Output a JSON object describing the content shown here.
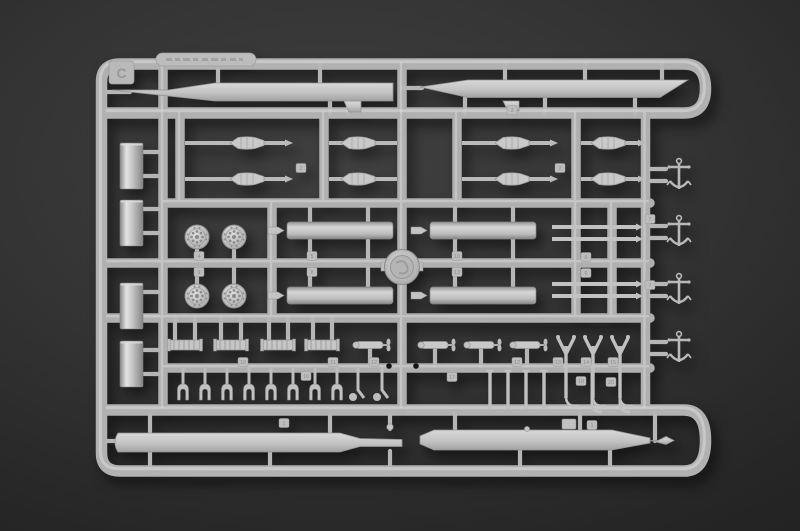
{
  "scene": {
    "subject": "Plastic model kit sprue C with molded ship parts photographed on a dark gray surface",
    "background_color": "#2e2e2e",
    "sprue_color": "#b3b3b3",
    "part_color": "#c8c8c8",
    "hole_color": "#141414"
  },
  "sprue": {
    "letter": "C",
    "nameplate": {
      "description": "embossed oval tag with illegible raised lettering",
      "legible": false
    },
    "part_number_tags": [
      {
        "label": "2",
        "x": 301,
        "y": 168
      },
      {
        "label": "2",
        "x": 560,
        "y": 168
      },
      {
        "label": "4",
        "x": 199,
        "y": 256
      },
      {
        "label": "9",
        "x": 199,
        "y": 272
      },
      {
        "label": "5",
        "x": 312,
        "y": 256
      },
      {
        "label": "8",
        "x": 312,
        "y": 272
      },
      {
        "label": "10",
        "x": 457,
        "y": 256
      },
      {
        "label": "13",
        "x": 457,
        "y": 272
      },
      {
        "label": "6",
        "x": 586,
        "y": 257
      },
      {
        "label": "6",
        "x": 586,
        "y": 273
      },
      {
        "label": "7",
        "x": 650,
        "y": 219
      },
      {
        "label": "7",
        "x": 650,
        "y": 285
      },
      {
        "label": "3",
        "x": 512,
        "y": 110
      },
      {
        "label": "16",
        "x": 306,
        "y": 376
      },
      {
        "label": "10",
        "x": 243,
        "y": 362
      },
      {
        "label": "11",
        "x": 333,
        "y": 362
      },
      {
        "label": "12",
        "x": 374,
        "y": 362
      },
      {
        "label": "12",
        "x": 517,
        "y": 362
      },
      {
        "label": "13",
        "x": 558,
        "y": 362
      },
      {
        "label": "14",
        "x": 586,
        "y": 362
      },
      {
        "label": "15",
        "x": 613,
        "y": 362
      },
      {
        "label": "17",
        "x": 452,
        "y": 377
      },
      {
        "label": "18",
        "x": 581,
        "y": 381
      },
      {
        "label": "20",
        "x": 611,
        "y": 382
      },
      {
        "label": "1",
        "x": 284,
        "y": 423
      },
      {
        "label": "1",
        "x": 592,
        "y": 425
      }
    ],
    "mounting_holes": [
      {
        "x": 389,
        "y": 366
      },
      {
        "x": 416,
        "y": 366
      }
    ]
  },
  "parts_inventory": {
    "long_blade_parts": 4,
    "funnel_cylinders": 4,
    "spindle_paravanes": 8,
    "perforated_discs": 4,
    "torpedo_tube_halves": 4,
    "tube_end_caps": 4,
    "ring_platform": 1,
    "barrel_rods": 8,
    "anchors": 4,
    "chain_winches": 4,
    "propeller_torpedoes": 4,
    "fork_davits": 8,
    "hook_davits": 2,
    "v_davits": 3,
    "j_davits": 2,
    "pins": 4
  }
}
